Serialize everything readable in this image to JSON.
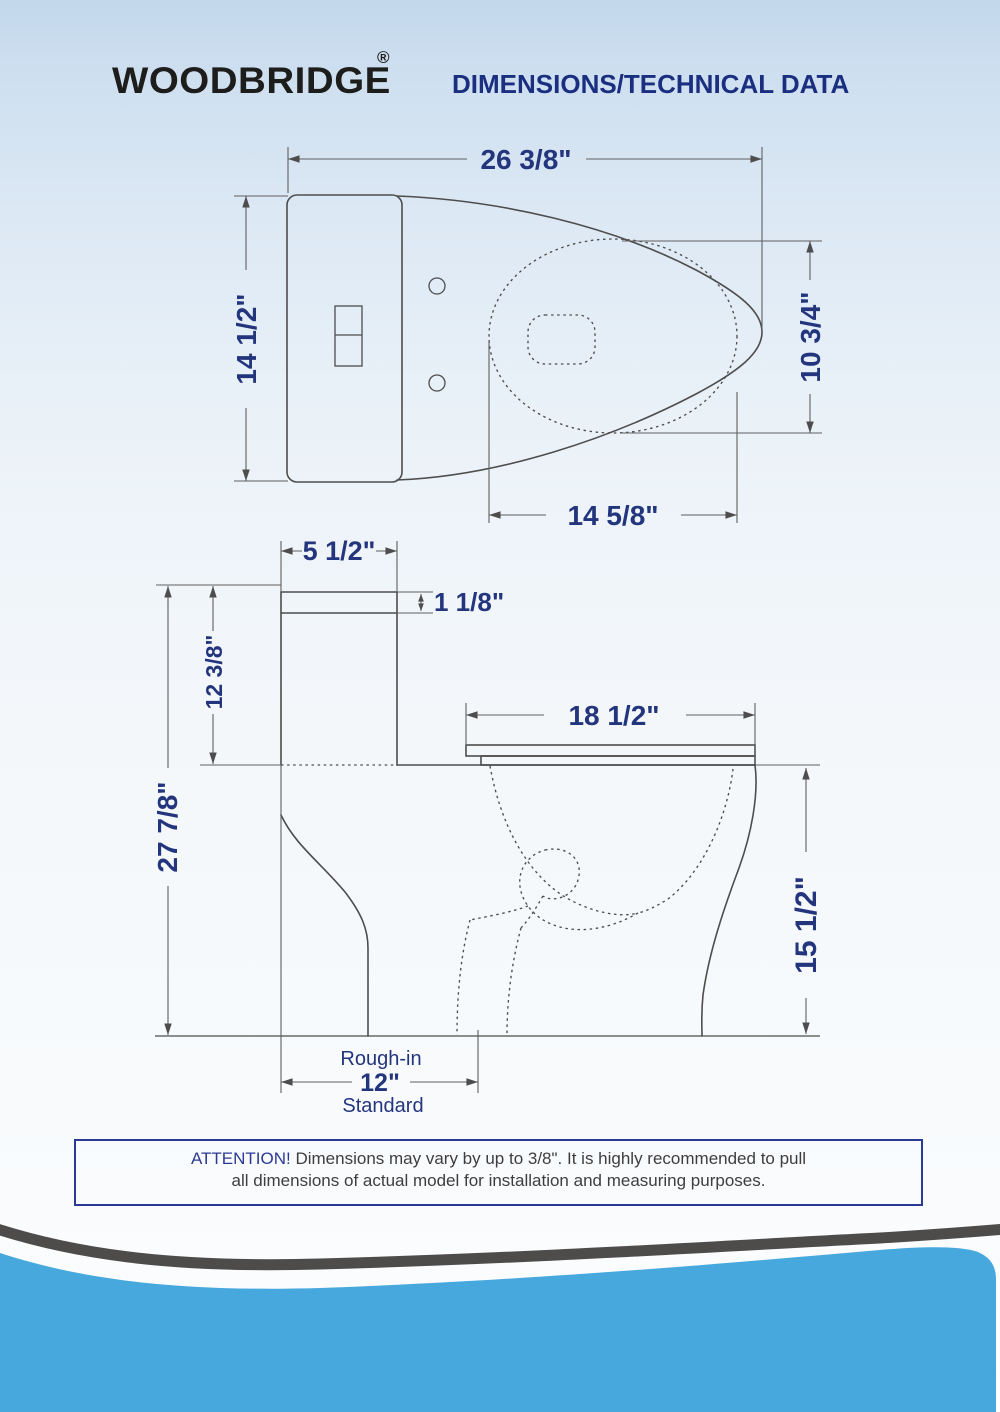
{
  "header": {
    "brand": "WOODBRIDGE",
    "registered_mark": "®",
    "title": "DIMENSIONS/TECHNICAL DATA"
  },
  "top_view": {
    "overall_length": "26 3/8\"",
    "overall_width": "14 1/2\"",
    "bowl_opening_width": "10 3/4\"",
    "bowl_opening_length": "14 5/8\""
  },
  "side_view": {
    "tank_lid_depth": "5 1/2\"",
    "lid_thickness": "1 1/8\"",
    "tank_height": "12 3/8\"",
    "overall_height": "27 7/8\"",
    "seat_length": "18 1/2\"",
    "rim_height": "15 1/2\"",
    "rough_in": {
      "label": "Rough-in",
      "value": "12\"",
      "note": "Standard"
    }
  },
  "attention": {
    "heading": "ATTENTION!",
    "line1": " Dimensions may vary by up to 3/8\". It is highly recommended to pull",
    "line2": "all dimensions of actual model for installation and measuring purposes."
  },
  "colors": {
    "dimension_navy": "#23357d",
    "line_gray": "#4d4d4d",
    "wave_blue": "#47a8de",
    "wave_dark": "#4d4c4a"
  }
}
